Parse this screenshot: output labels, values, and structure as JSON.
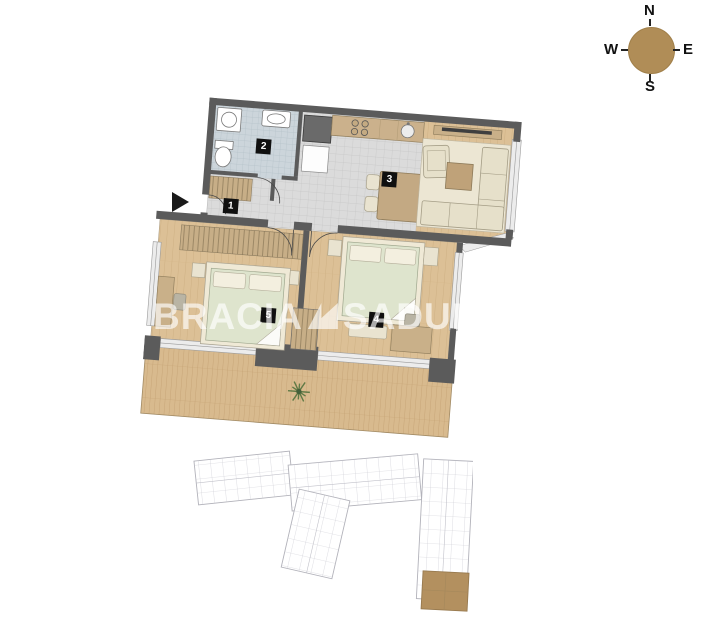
{
  "compass": {
    "north": "N",
    "east": "E",
    "south": "S",
    "west": "W"
  },
  "watermark": {
    "brand_first": "BRACIA",
    "brand_second": "SADUR"
  },
  "floor_plan": {
    "rooms": [
      {
        "number": "1",
        "name": "hall"
      },
      {
        "number": "2",
        "name": "bathroom"
      },
      {
        "number": "3",
        "name": "kitchen-living-room"
      },
      {
        "number": "4",
        "name": "bedroom-right"
      },
      {
        "number": "5",
        "name": "bedroom-left"
      }
    ]
  },
  "colors": {
    "compass_circle": "#b08d57",
    "walls": "#5b5b5b",
    "wood_floor": "#dcc096",
    "terrace_deck": "#d8ba8e",
    "kitchen_tile": "#dbdbdb",
    "bathroom_tile": "#ccd5db",
    "mattress_green": "#dee4cd",
    "furniture_cream": "#e6e0ca",
    "furniture_wood": "#c9b089",
    "site_outline": "#b2b2ba",
    "site_highlight": "#b3905f",
    "watermark": "rgba(255,255,255,0.65)"
  }
}
